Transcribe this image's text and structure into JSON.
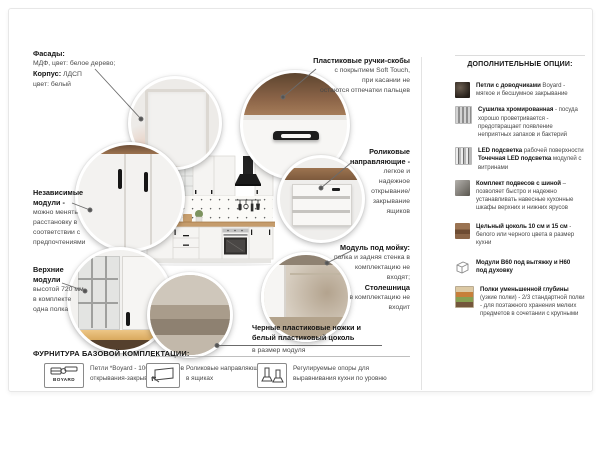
{
  "facade": {
    "title": "Фасады:",
    "line1": "МДФ, цвет: белое дерево;",
    "title2": "Корпус:",
    "title2_value": "ЛДСП",
    "line2": "цвет: белый"
  },
  "handles": {
    "title": "Пластиковые ручки-скобы",
    "lines": [
      "с покрытием Soft Touch,",
      "при касании не",
      "остаются отпечатки пальцев"
    ]
  },
  "independent": {
    "title": [
      "Независимые",
      "модули -"
    ],
    "lines": [
      "можно менять",
      "расстановку в",
      "соответствии с",
      "предпочтениями"
    ]
  },
  "upper": {
    "title": [
      "Верхние",
      "модули"
    ],
    "lines": [
      "высотой 720 мм",
      "в комплекте",
      "одна полка"
    ]
  },
  "rollers": {
    "title": [
      "Роликовые",
      "направляющие -"
    ],
    "lines": [
      "легкое и",
      "надежное",
      "открывание/",
      "закрывание",
      "ящиков"
    ]
  },
  "sink": {
    "title": "Модуль под мойку:",
    "lines": [
      "полка и задняя стенка в",
      "комплектацию не",
      "входят;"
    ],
    "title2": "Столешница",
    "lines2": [
      "в комплектацию не",
      "входит"
    ]
  },
  "plinth": {
    "bold": [
      "Черные пластиковые ножки и",
      "белый пластиковый цоколь"
    ],
    "note": "в размер модуля"
  },
  "hardware": {
    "header": "ФУРНИТУРА БАЗОВОЙ КОМПЛЕКТАЦИИ:",
    "items": [
      {
        "icon": "boyard-hinge-icon",
        "icon_label": "BOYARD",
        "lines": [
          "Петли *Boyard - 100тыс. циклов",
          "открывания-закрывания"
        ]
      },
      {
        "icon": "drawer-slides-icon",
        "lines": [
          "Роликовые направляющие",
          "в ящиках"
        ]
      },
      {
        "icon": "adjustable-feet-icon",
        "lines": [
          "Регулируемые опоры для",
          "выравнивания кухни по уровню"
        ]
      }
    ]
  },
  "options": {
    "header": "ДОПОЛНИТЕЛЬНЫЕ ОПЦИИ:",
    "items": [
      {
        "icon": "hinge-photo",
        "b1": "Петли с доводчиками",
        "r1": " Boyard - мягкое и бесшумное закрывание",
        "b2": "",
        "r2": ""
      },
      {
        "icon": "chrome-dryer-photo",
        "b1": "Сушилка хромированная",
        "r1": " - посуда хорошо проветривается - предотвращает появление неприятных запахов и бактерий",
        "b2": "",
        "r2": ""
      },
      {
        "icon": "led-light-photo",
        "b1": "LED подсветка",
        "r1": " рабочей поверхности ",
        "b2": "Точечная LED подсветка",
        "r2": " модулей с витринами"
      },
      {
        "icon": "hanging-rail-kit-photo",
        "b1": "Комплект подвесов с шиной",
        "r1": " – позволяет быстро и надежно устанавливать навесные кухонные шкафы верхних и нижних ярусов",
        "b2": "",
        "r2": ""
      },
      {
        "icon": "solid-plinth-photo",
        "b1": "Цельный цоколь 10 см и 15 см",
        "r1": " - белого или черного цвета в размер кухни",
        "b2": "",
        "r2": ""
      },
      {
        "icon": "module-box-icon",
        "b1": "Модули В60 под вытяжку и Н60 под духовку",
        "r1": "",
        "b2": "",
        "r2": ""
      },
      {
        "icon": "narrow-shelves-photo",
        "b1": "Полки уменьшенной глубины",
        "r1": " (узкие полки) - 2/3 стандартной полки - для поэтажного хранения мелких предметов в сочетании с крупными",
        "b2": "",
        "r2": ""
      }
    ]
  },
  "colors": {
    "wood": "#c59c6c",
    "hood": "#1b1b1b",
    "text": "#4a4a4a",
    "bold": "#141414",
    "leader_line": "#6b6b6b",
    "border": "#e7e7e7"
  }
}
